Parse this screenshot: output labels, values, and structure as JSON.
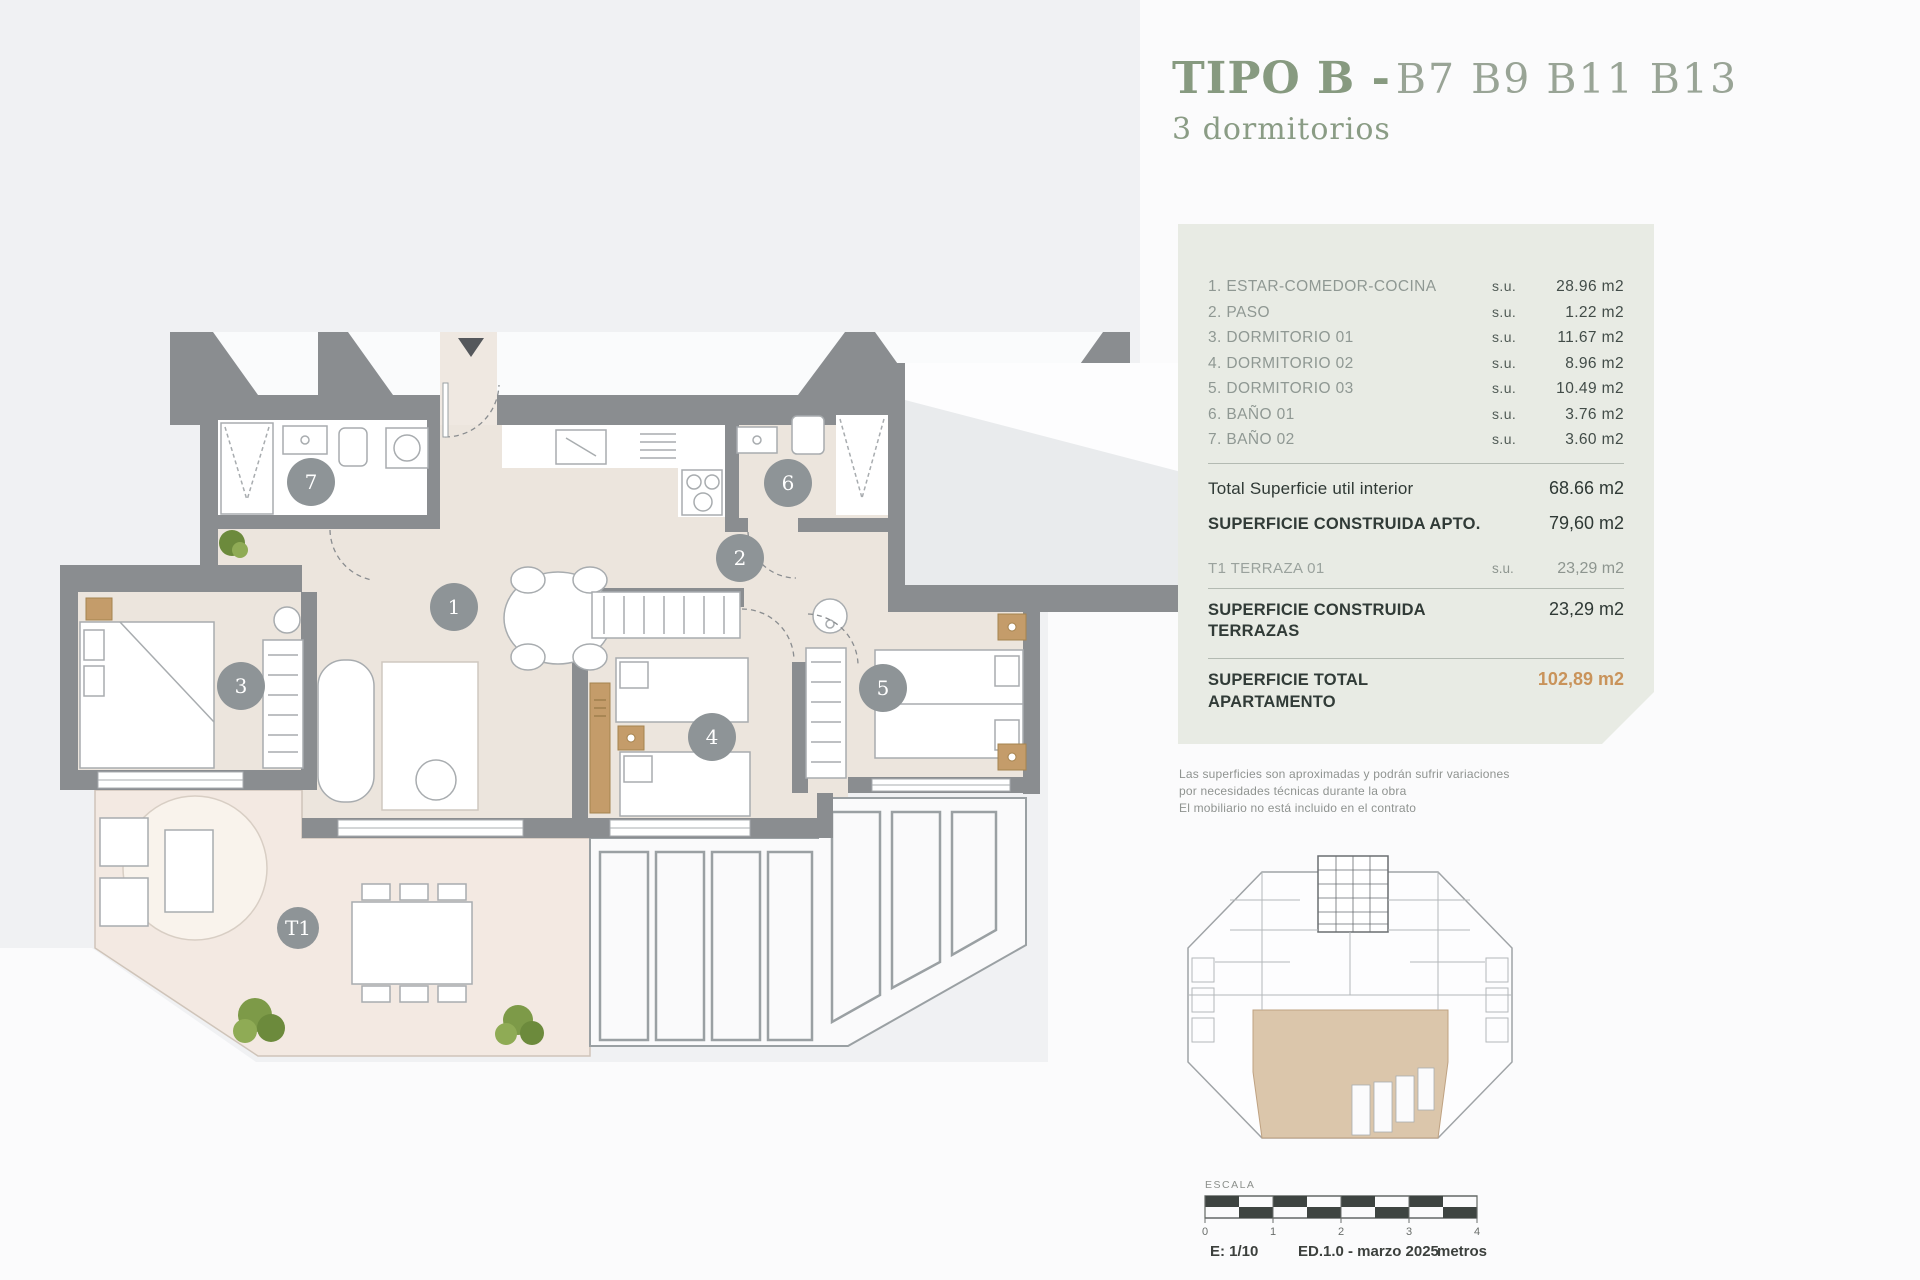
{
  "page": {
    "title_bold": "TIPO B -",
    "title_units": "B7 B9 B11 B13",
    "subtitle": "3 dormitorios"
  },
  "areas_panel": {
    "rooms": [
      {
        "label": "1. ESTAR-COMEDOR-COCINA",
        "su": "s.u.",
        "value": "28.96 m2"
      },
      {
        "label": "2. PASO",
        "su": "s.u.",
        "value": "1.22 m2"
      },
      {
        "label": "3. DORMITORIO 01",
        "su": "s.u.",
        "value": "11.67 m2"
      },
      {
        "label": "4. DORMITORIO 02",
        "su": "s.u.",
        "value": "8.96 m2"
      },
      {
        "label": "5. DORMITORIO 03",
        "su": "s.u.",
        "value": "10.49 m2"
      },
      {
        "label": "6. BAÑO 01",
        "su": "s.u.",
        "value": "3.76 m2"
      },
      {
        "label": "7. BAÑO 02",
        "su": "s.u.",
        "value": "3.60 m2"
      }
    ],
    "total_util": {
      "label": "Total Superficie util interior",
      "value": "68.66 m2"
    },
    "construida_apto": {
      "label": "SUPERFICIE CONSTRUIDA APTO.",
      "value": "79,60 m2"
    },
    "terraza": {
      "label": "T1 TERRAZA 01",
      "su": "s.u.",
      "value": "23,29 m2"
    },
    "construida_terrazas": {
      "label_line1": "SUPERFICIE CONSTRUIDA",
      "label_line2": "TERRAZAS",
      "value": "23,29 m2"
    },
    "total_apartamento": {
      "label_line1": "SUPERFICIE TOTAL",
      "label_line2": "APARTAMENTO",
      "value": "102,89 m2"
    }
  },
  "disclaimer": {
    "line1": "Las superficies son aproximadas y podrán sufrir variaciones",
    "line2": "por necesidades técnicas durante la obra",
    "line3": "El mobiliario no está incluido en el contrato"
  },
  "plan": {
    "markers": [
      {
        "label": "1"
      },
      {
        "label": "2"
      },
      {
        "label": "3"
      },
      {
        "label": "4"
      },
      {
        "label": "5"
      },
      {
        "label": "6"
      },
      {
        "label": "7"
      },
      {
        "label": "T1"
      }
    ]
  },
  "scale_bar": {
    "escala": "ESCALA",
    "ticks": [
      "0",
      "1",
      "2",
      "3",
      "4"
    ],
    "scale": "E: 1/10",
    "edition": "ED.1.0 - marzo 2025",
    "units": "metros"
  },
  "colors": {
    "accent_green": "#8c9d85",
    "accent_orange": "#c9935a",
    "panel_bg": "#e8ebe4",
    "wall_gray": "#8a8d90",
    "highlight_tan": "#d8c1a4"
  }
}
